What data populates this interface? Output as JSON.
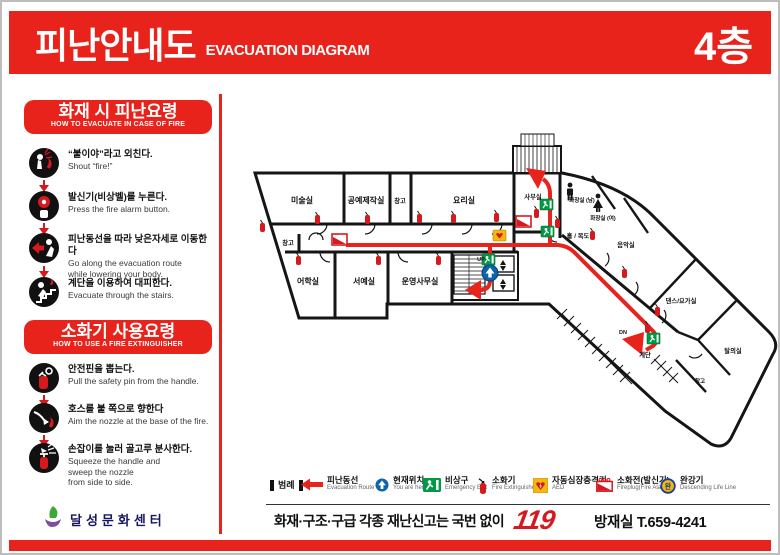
{
  "header": {
    "title_ko": "피난안내도",
    "title_en": "EVACUATION DIAGRAM",
    "floor": "4층"
  },
  "sidebar": {
    "evacuation_section": {
      "title_ko": "화재 시 피난요령",
      "title_en": "HOW TO EVACUATE IN CASE OF FIRE",
      "steps": [
        {
          "icon": "shout-fire-icon",
          "ko": "“불이야”라고 외친다.",
          "en": "Shout “fire!”"
        },
        {
          "icon": "alarm-button-icon",
          "ko": "발신기(비상벨)를 누른다.",
          "en": "Press the fire alarm button."
        },
        {
          "icon": "evacuate-low-icon",
          "ko": "피난동선을 따라 낮은자세로 이동한다",
          "en": "Go along the evacuation route",
          "en2": "while lowering your body."
        },
        {
          "icon": "stairs-evacuate-icon",
          "ko": "계단을 이용하여 대피한다.",
          "en": "Evacuate through the stairs."
        }
      ]
    },
    "extinguisher_section": {
      "title_ko": "소화기 사용요령",
      "title_en": "HOW TO USE A FIRE EXTINGUISHER",
      "steps": [
        {
          "icon": "pull-pin-icon",
          "ko": "안전핀을 뽑는다.",
          "en": "Pull the safety pin from the handle."
        },
        {
          "icon": "aim-nozzle-icon",
          "ko": "호스를 불 쪽으로 향한다",
          "en": "Aim the nozzle at the base of the fire."
        },
        {
          "icon": "squeeze-handle-icon",
          "ko": "손잡이를 눌러 골고루 분사한다.",
          "en": "Squeeze the handle and",
          "en2": "sweep the nozzle",
          "en3": "from side to side."
        }
      ]
    },
    "logo_text": "달성문화센터"
  },
  "map": {
    "rooms": [
      {
        "label": "미술실"
      },
      {
        "label": "공예제작실"
      },
      {
        "label": "창고"
      },
      {
        "label": "요리실"
      },
      {
        "label": "사무실"
      },
      {
        "label": "창고"
      },
      {
        "label": "어학실"
      },
      {
        "label": "서예실"
      },
      {
        "label": "운영사무실"
      },
      {
        "label": "화장실 (남)"
      },
      {
        "label": "화장실 (여)"
      },
      {
        "label": "홀 / 복도"
      },
      {
        "label": "음악실"
      },
      {
        "label": "댄스/요가실"
      },
      {
        "label": "탈의실"
      },
      {
        "label": "창고"
      },
      {
        "label": "계단"
      }
    ],
    "annotations": {
      "up": "UP",
      "dn": "DN"
    }
  },
  "legend": {
    "title": "범례",
    "items": [
      {
        "icon": "evacuation-route-icon",
        "ko": "피난동선",
        "en": "Evacuation Route"
      },
      {
        "icon": "current-location-icon",
        "ko": "현재위치",
        "en": "You are here"
      },
      {
        "icon": "emergency-exit-icon",
        "ko": "비상구",
        "en": "Emergency Exit"
      },
      {
        "icon": "fire-extinguisher-icon",
        "ko": "소화기",
        "en": "Fire Extinguisher"
      },
      {
        "icon": "aed-icon",
        "ko": "자동심장충격기",
        "en": "AED"
      },
      {
        "icon": "fireplug-icon",
        "ko": "소화전(발신기)",
        "en": "Fireplug(Fire Alarm)"
      },
      {
        "icon": "descending-life-line-icon",
        "ko": "완강기",
        "en": "Descending Life Line",
        "icon_char": "완"
      }
    ]
  },
  "footer": {
    "report_text": "화재·구조·구급 각종 재난신고는 국번 없이",
    "emergency_number": "119",
    "control_room": "방재실 T.659-4241"
  },
  "colors": {
    "accent_red": "#e8231c",
    "exit_green": "#009a44",
    "location_blue": "#0b63b2",
    "aed_yellow": "#f6b70e"
  }
}
